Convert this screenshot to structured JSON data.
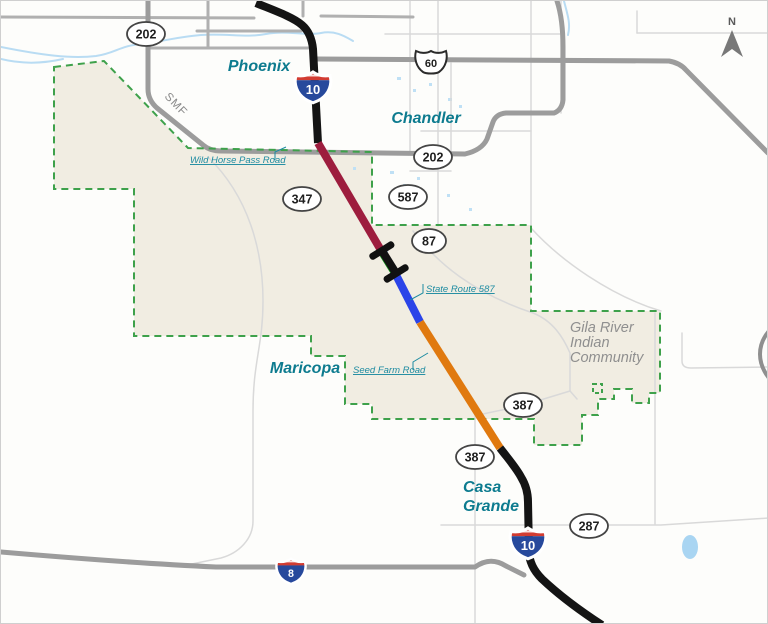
{
  "compass": {
    "label": "N"
  },
  "cities": {
    "phoenix": "Phoenix",
    "chandler": "Chandler",
    "maricopa": "Maricopa",
    "casa_grande_line1": "Casa",
    "casa_grande_line2": "Grande"
  },
  "region_labels": {
    "gila_river_line1": "Gila River",
    "gila_river_line2": "Indian",
    "gila_river_line3": "Community"
  },
  "road_labels": {
    "smf": "SMF",
    "wild_horse_pass": "Wild Horse Pass Road",
    "state_route_587": "State Route 587",
    "seed_farm": "Seed Farm Road"
  },
  "shields": {
    "loop202_nw": "202",
    "us60": "60",
    "loop202_e": "202",
    "sr587": "587",
    "sr87": "87",
    "sr347": "347",
    "sr387_n": "387",
    "sr387_s": "387",
    "sr287": "287",
    "i10_north": "10",
    "i10_south": "10",
    "i8": "8"
  },
  "corridor": {
    "segments": [
      {
        "name": "existing-i10-north",
        "color": "#141414"
      },
      {
        "name": "segment-maroon",
        "color": "#9d1d3e"
      },
      {
        "name": "segment-green",
        "color": "#129119"
      },
      {
        "name": "segment-blue",
        "color": "#2b44e8"
      },
      {
        "name": "segment-orange",
        "color": "#e0790f"
      },
      {
        "name": "existing-i10-south",
        "color": "#141414"
      }
    ]
  },
  "palette": {
    "boundary_green": "#3ea14b",
    "reservation_fill": "#f1ede2",
    "water_blue": "#b9dcf3",
    "city_teal": "#0d7b8f",
    "callout_teal": "#1d8ba1",
    "interstate_red": "#d23c32",
    "interstate_blue": "#27499c"
  }
}
